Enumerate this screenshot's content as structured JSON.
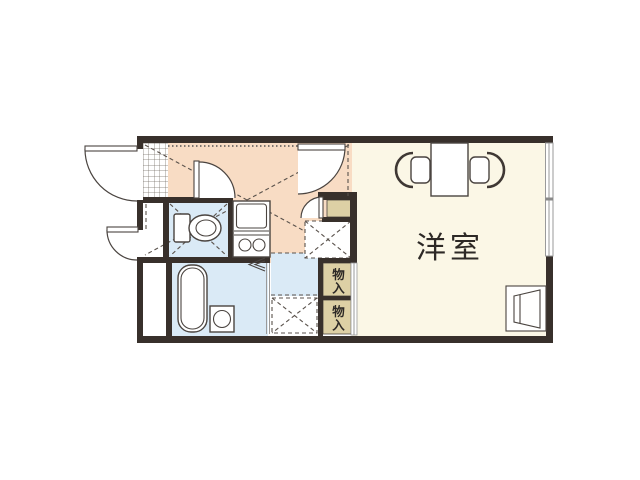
{
  "figure": "apartment-floor-plan",
  "labels": {
    "western_room": "洋室",
    "storage_top": "物入",
    "storage_bottom": "物入"
  },
  "colors": {
    "wall": "#38302b",
    "western": "#fbf7e6",
    "hall": "#f8dcc4",
    "wet": "#daeaf6",
    "storage": "#ddd0a5"
  }
}
